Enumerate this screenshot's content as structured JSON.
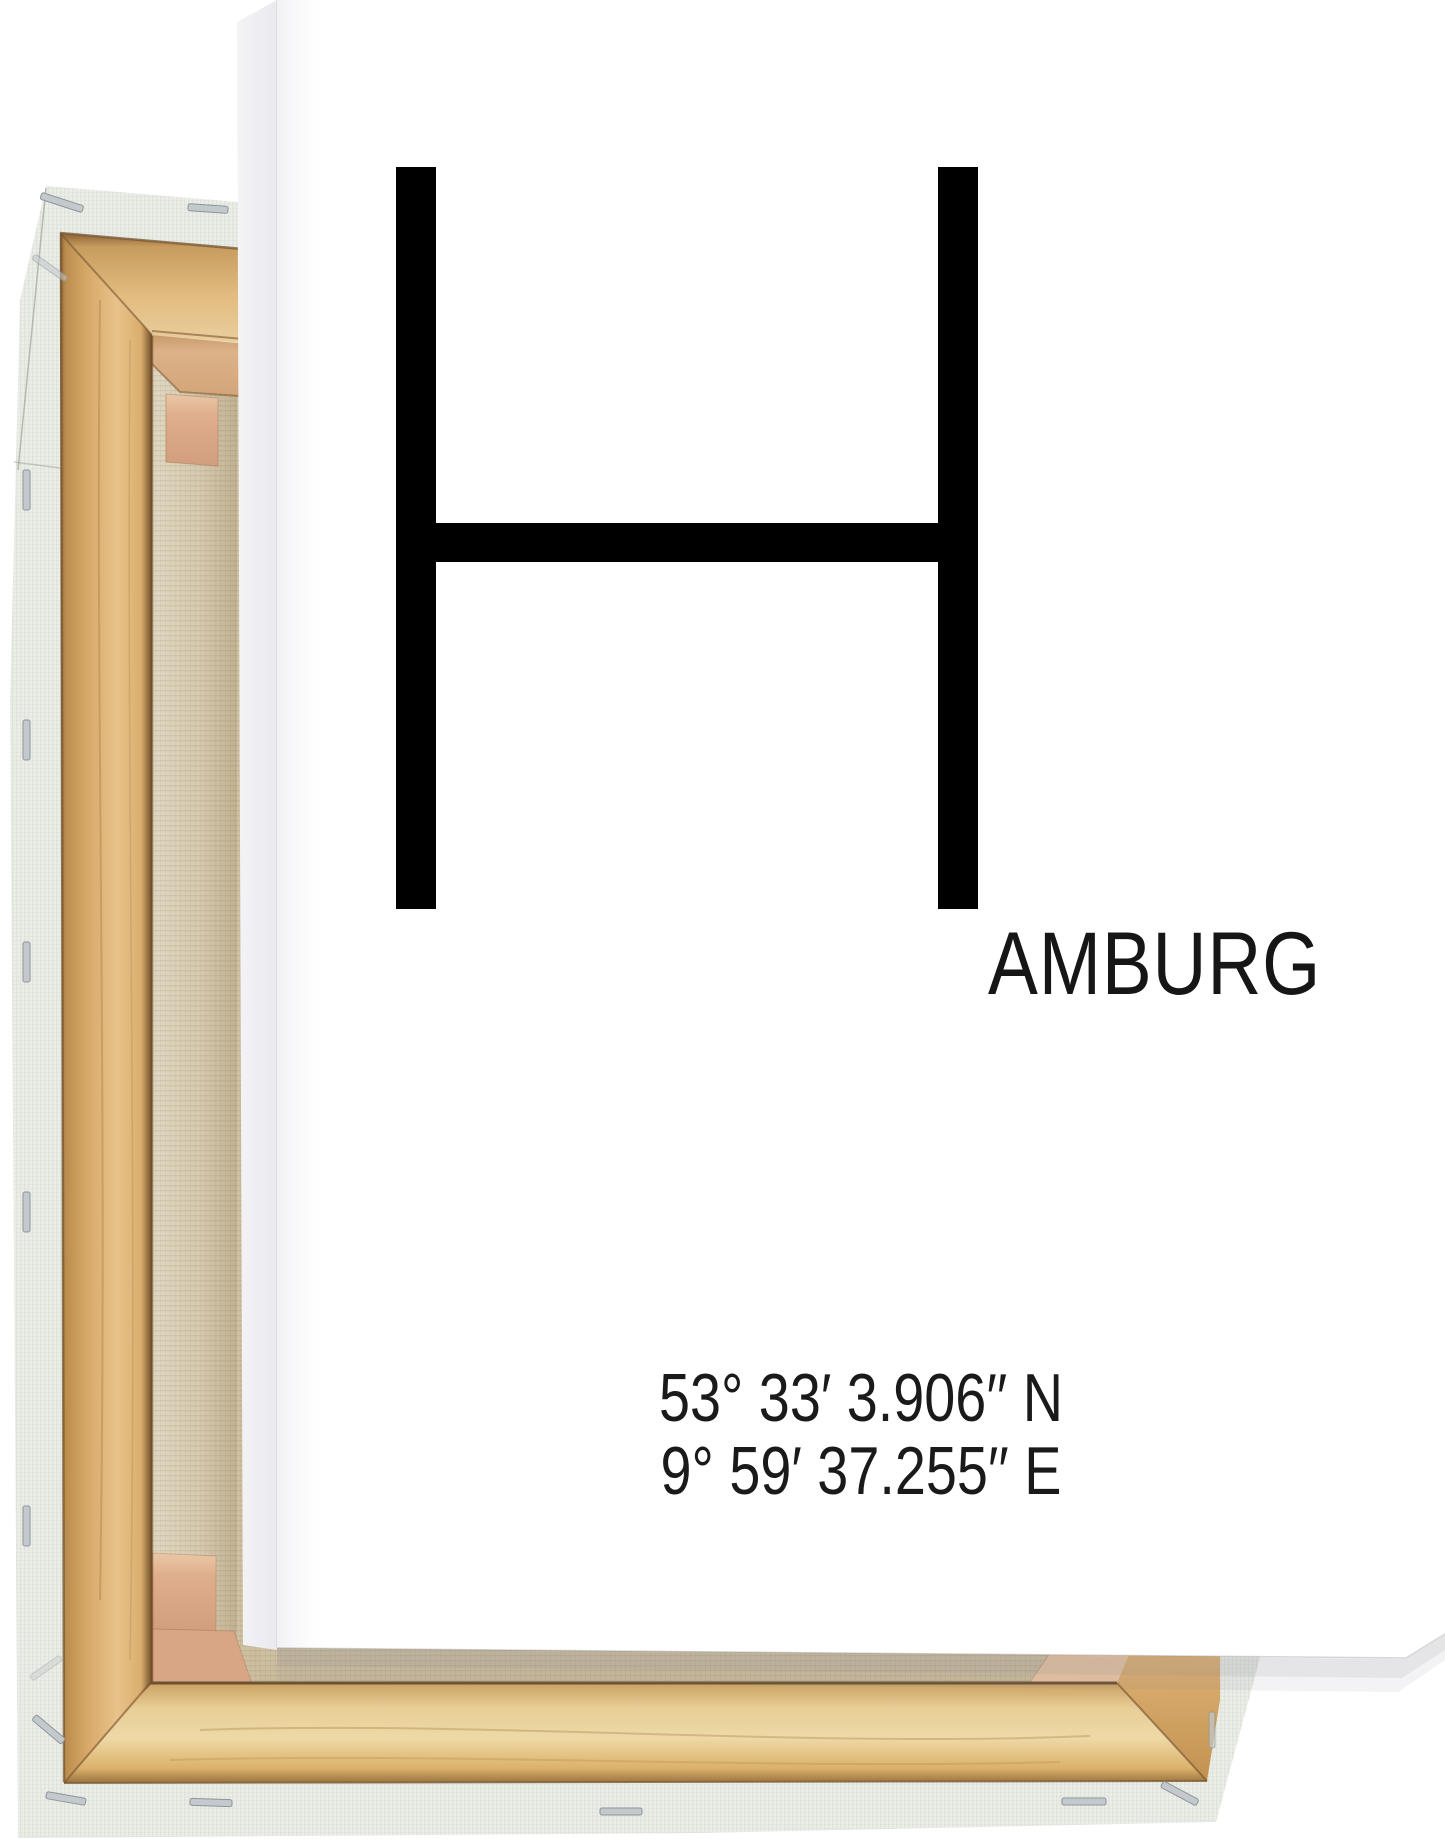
{
  "poster": {
    "letter": "H",
    "city_suffix": "AMBURG",
    "coordinates": {
      "line1": "53° 33′ 3.906′′ N",
      "line2": "9° 59′ 37.255′′ E"
    }
  },
  "colors": {
    "background": "#ffffff",
    "poster_white": "#ffffff",
    "poster_edge_gray": "#efeff2",
    "text_black": "#000000",
    "wood_light": "#e7c28a",
    "wood_dark": "#8a6134",
    "canvas_back_tan": "#d2c4a6",
    "canvas_wrap_pale": "#ebeee7",
    "corner_brace_pink": "#dfae8c",
    "staple_silver": "#c3c9cc"
  }
}
